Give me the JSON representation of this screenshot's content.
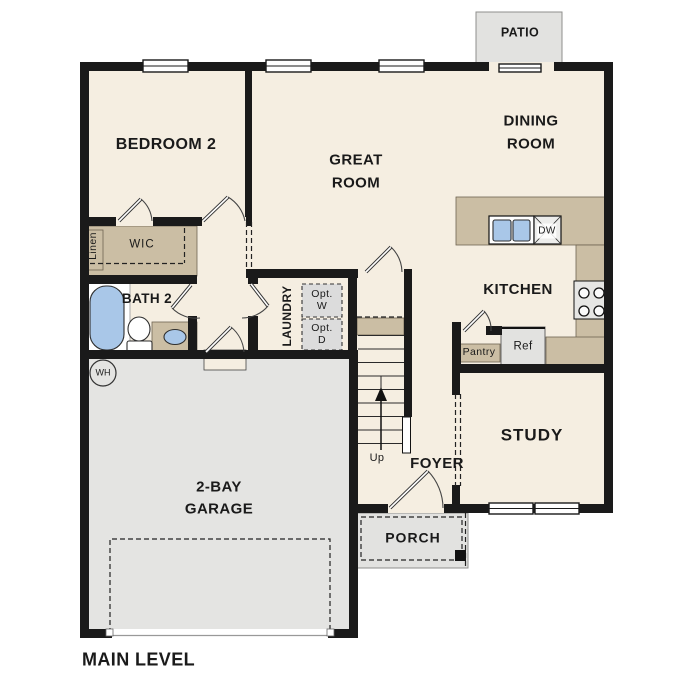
{
  "plan": {
    "title": "MAIN LEVEL",
    "type": "floor-plan"
  },
  "labels": {
    "bedroom2": "BEDROOM 2",
    "great_room": "GREAT\nROOM",
    "dining_room": "DINING\nROOM",
    "kitchen": "KITCHEN",
    "study": "STUDY",
    "foyer": "FOYER",
    "laundry": "LAUNDRY",
    "bath2": "BATH 2",
    "wic": "WIC",
    "linen": "Linen",
    "pantry": "Pantry",
    "garage": "2-BAY\nGARAGE",
    "porch": "PORCH",
    "patio": "PATIO",
    "ref": "Ref",
    "dw": "DW",
    "opt_w": "Opt.\nW",
    "opt_d": "Opt.\nD",
    "wh": "WH",
    "up": "Up",
    "main_level": "MAIN LEVEL"
  },
  "colors": {
    "wall": "#1a1a1a",
    "floor": "#f5eee1",
    "garage": "#e4e4e2",
    "outdoor": "#e2e2e0",
    "counter": "#cbbea4",
    "blue": "#a9c7e8",
    "appliance": "#dcdcdc",
    "ink": "#1a1a1a"
  }
}
